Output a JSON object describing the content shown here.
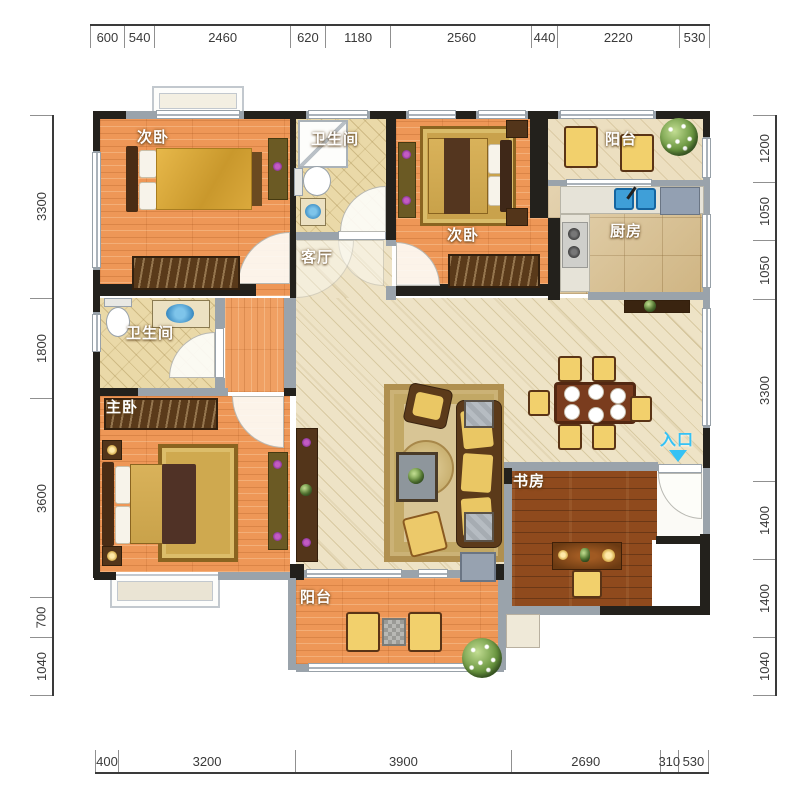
{
  "plan": {
    "room_labels": [
      {
        "id": "bedroom-top-left",
        "label": "次卧"
      },
      {
        "id": "bathroom-top",
        "label": "卫生间"
      },
      {
        "id": "bedroom-top-right",
        "label": "次卧"
      },
      {
        "id": "balcony-top",
        "label": "阳台"
      },
      {
        "id": "kitchen",
        "label": "厨房"
      },
      {
        "id": "living-room",
        "label": "客厅"
      },
      {
        "id": "bathroom-left",
        "label": "卫生间"
      },
      {
        "id": "master-bedroom",
        "label": "主卧"
      },
      {
        "id": "study",
        "label": "书房"
      },
      {
        "id": "balcony-bottom",
        "label": "阳台"
      },
      {
        "id": "entrance",
        "label": "入口"
      }
    ],
    "colors": {
      "entrance_accent": "#35c2f5",
      "dimension_text": "#3a3a3a",
      "wall_dark": "#23211c",
      "wall_light": "#9aa3ab",
      "wood_floor": "#ee9757",
      "tile_floor": "#eee3c6",
      "bath_tile": "#ead9a8",
      "kitchen_marble": "#d9c08e",
      "study_floor": "#8f4a1d"
    }
  },
  "rulers": {
    "top": [
      600,
      540,
      2460,
      620,
      1180,
      2560,
      440,
      2220,
      530
    ],
    "bottom": [
      400,
      3200,
      3900,
      2690,
      310,
      530
    ],
    "left": [
      3300,
      1800,
      3600,
      700,
      1040
    ],
    "right": [
      1200,
      1050,
      1050,
      3300,
      1400,
      1400,
      1040
    ]
  }
}
